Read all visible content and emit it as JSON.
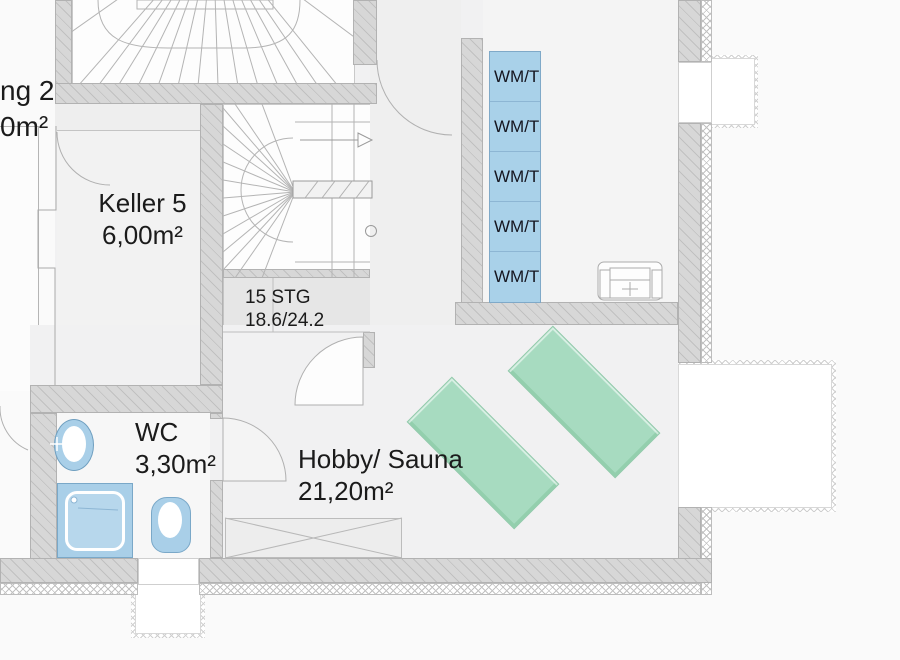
{
  "drawing_type": "basement floor plan",
  "rooms": {
    "keller": {
      "name": "Keller 5",
      "area": "6,00m²"
    },
    "wc": {
      "name": "WC",
      "area": "3,30m²"
    },
    "hobby": {
      "name": "Hobby/ Sauna",
      "area": "21,20m²"
    }
  },
  "stair": {
    "steps_label": "15 STG",
    "dimensions_label": "18.6/24.2"
  },
  "clipped_left_room": {
    "name_fragment": "ng 2",
    "area_fragment": "0m²"
  },
  "laundry": {
    "units": [
      {
        "label": "WM/T"
      },
      {
        "label": "WM/T"
      },
      {
        "label": "WM/T"
      },
      {
        "label": "WM/T"
      },
      {
        "label": "WM/T"
      }
    ]
  },
  "colors": {
    "wall": "#d7d7d7",
    "floor": "#f1f1f2",
    "laundry_blue": "#a9d1e9",
    "fixture_blue": "#a9cfe8",
    "lounger_green": "#a7dbc0",
    "text": "#1b1b1b"
  }
}
